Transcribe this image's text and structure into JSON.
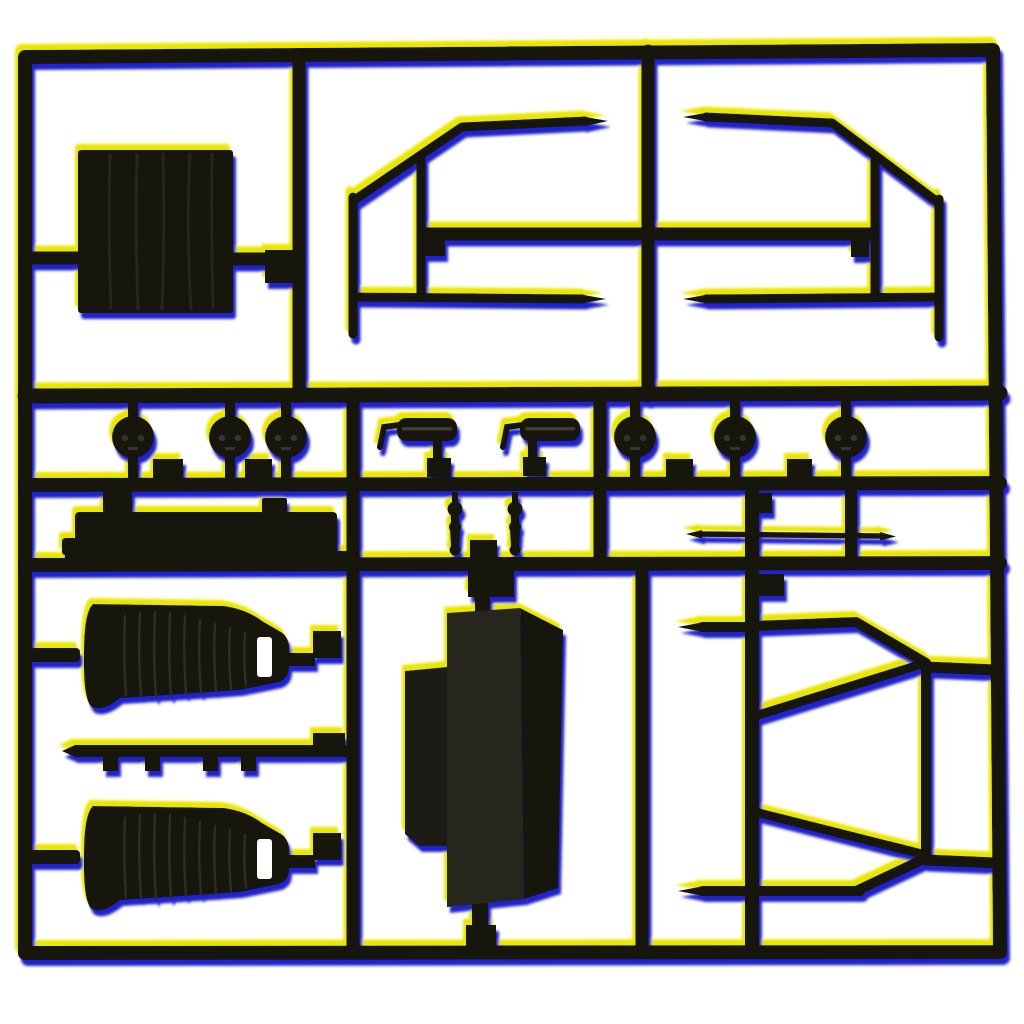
{
  "scene": {
    "type": "product-photo",
    "subject": "Injection-molded black plastic model kit sprue (parts tree) on a white background, photographed with strong chromatic aberration",
    "background_color": "#ffffff"
  },
  "colors": {
    "background": "#ffffff",
    "plastic": "#121210",
    "plastic_deep": "#0c0c0a",
    "rib_highlight": "#28281f",
    "seat_pleat": "#2e2e26",
    "cylinder_highlight": "#3c3c30",
    "headlight_dot": "#353530",
    "tank_front": "#26261e",
    "tank_side": "#15150f",
    "tank_panel": "#1e1e17",
    "fringe_yellow": "#e9e600",
    "fringe_blue": "#2424cc"
  },
  "parts": {
    "sprue_frame": "outer rectangular runner frame with internal runner grid",
    "radiator_panel": "ribbed radiator / grille panel",
    "cab_frame_left": "cab window frame, left half, with pointed runner tips",
    "cab_frame_right": "cab window frame, right half, mirrored",
    "headlights": "six round lamp backs with twin pin marks",
    "cylinders": "two ribbed cylinder parts with hooked brackets",
    "shock_absorbers": "two small turned shock absorber parts",
    "chassis_rail": "stepped chassis rail / bumper bar",
    "axle_rod": "thin double-pointed axle rod",
    "bucket_seats": "two pleated bucket seats with mounting slot",
    "clip_strip": "thin runner strip with four small clips",
    "fuel_tank": "large rectangular fuel tank box with side panel",
    "rear_cage": "rear guard cage with beveled corners and diagonal braces"
  },
  "counts": {
    "headlights": 6,
    "seats": 2,
    "cylinders": 2,
    "shock_absorbers": 2,
    "clips": 4
  }
}
